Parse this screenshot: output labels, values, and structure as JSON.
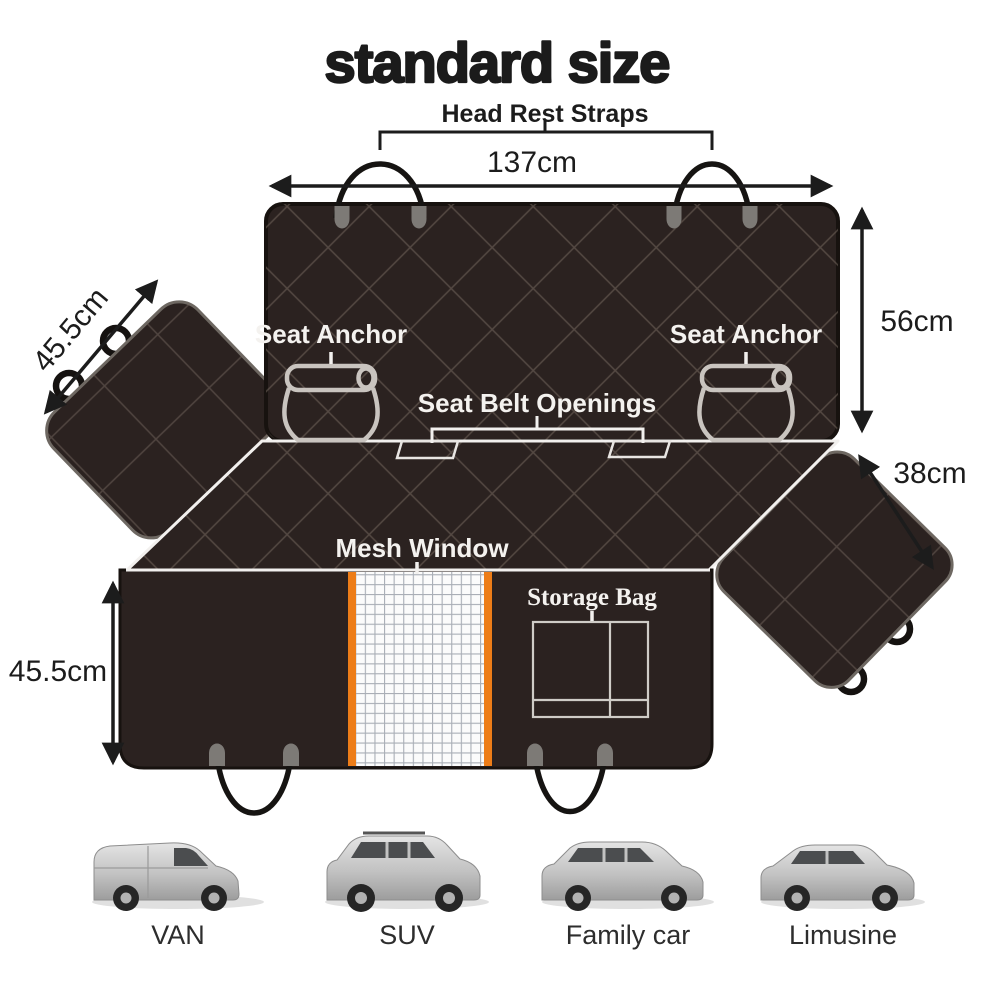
{
  "title": "standard size",
  "labels": {
    "head_rest_straps": "Head Rest Straps",
    "seat_anchor_left": "Seat Anchor",
    "seat_anchor_right": "Seat Anchor",
    "seat_belt_openings": "Seat Belt Openings",
    "mesh_window": "Mesh Window",
    "storage_bag": "Storage Bag"
  },
  "dimensions": {
    "total_width": "137cm",
    "backrest_height": "56cm",
    "right_flap_width": "38cm",
    "left_flap_width": "45.5cm",
    "seat_depth": "45.5cm"
  },
  "vehicles": [
    {
      "label": "VAN"
    },
    {
      "label": "SUV"
    },
    {
      "label": "Family car"
    },
    {
      "label": "Limusine"
    }
  ],
  "colors": {
    "cover_fabric": "#2b2220",
    "quilt_line": "#6f635a",
    "mesh_trim_orange": "#ed7d18",
    "mesh_background": "#fbfbfb",
    "outline_white": "#f2f0ee",
    "strap_tab_gray": "#7d7a76",
    "annotation_black": "#1c1c1c",
    "car_silver": "#c2c2c2"
  }
}
